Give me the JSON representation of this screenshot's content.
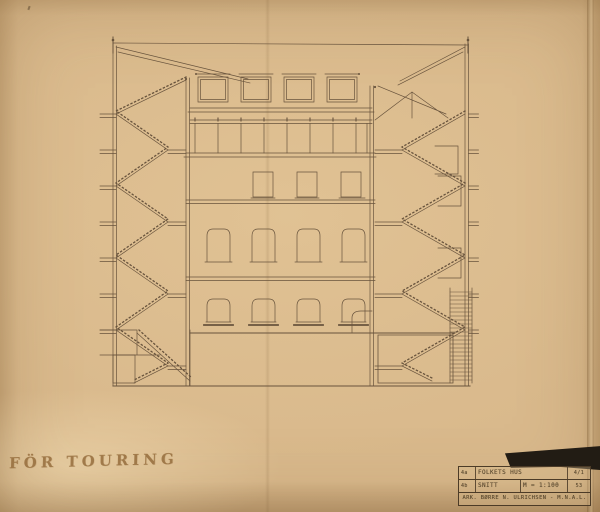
{
  "paper": {
    "color": "#d9b98c",
    "ink": "#5f4b36",
    "backdrop": "#221c14"
  },
  "handwriting": {
    "note": "FÖR TOURING"
  },
  "title_block": {
    "row1": {
      "index": "4a",
      "project": "FOLKETS HUS",
      "sheet": "4/1"
    },
    "row2": {
      "index": "4b",
      "drawing": "SNITT",
      "scale": "M = 1:100",
      "number": "53"
    },
    "row3": {
      "architect": "ARK. BØRRE N. ULRICHSEN - M.N.A.L."
    }
  }
}
